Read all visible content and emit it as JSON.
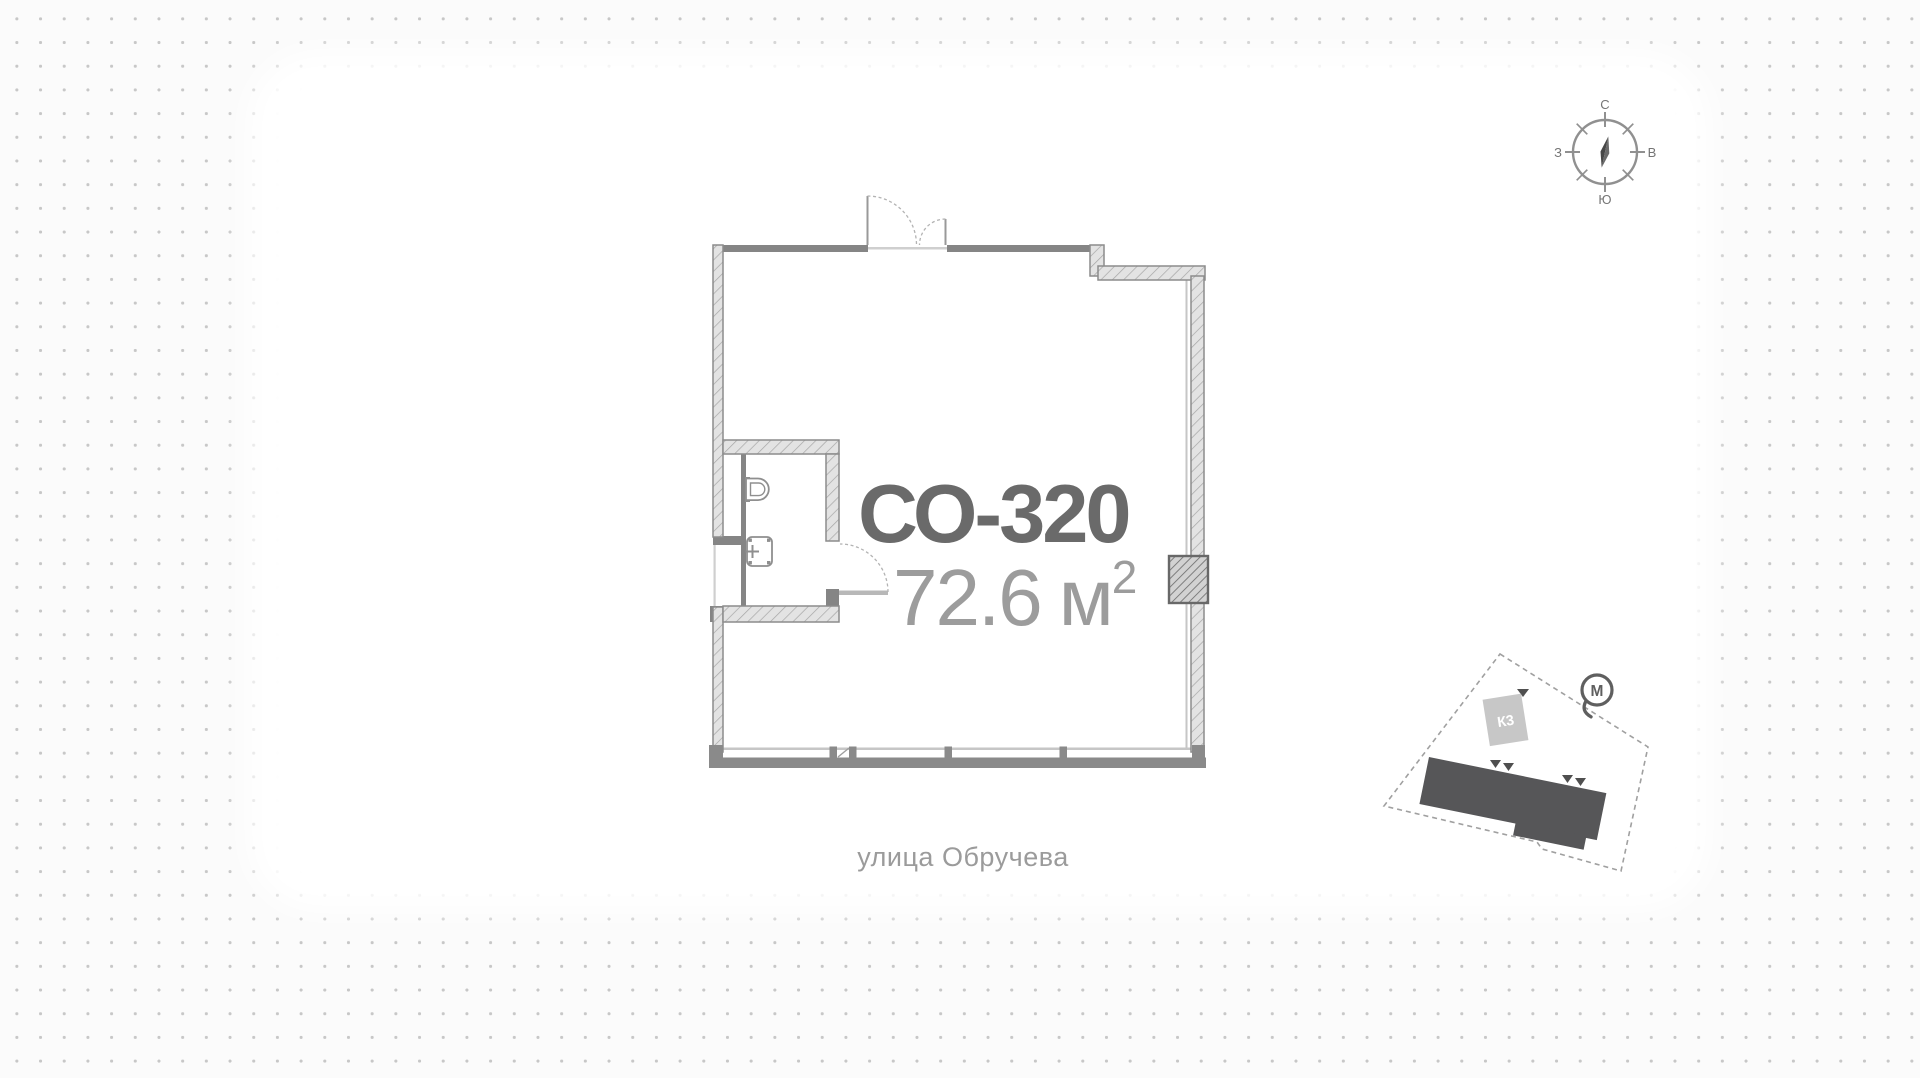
{
  "unit": {
    "title": "СО-320",
    "area_value": "72.6",
    "area_unit": "м",
    "area_exp": "2"
  },
  "street": {
    "label": "улица Обручева"
  },
  "compass": {
    "north": "С",
    "south": "Ю",
    "west": "З",
    "east": "В"
  },
  "site_map": {
    "building_label": "К3",
    "metro_label": "М"
  },
  "colors": {
    "wall": "#858585",
    "wall_hatch_bg": "#e3e3e3",
    "window_line": "#cbcbcb",
    "title_text": "#6a6a6a",
    "muted_text": "#9b9b9b",
    "dot_grid": "#c7c7c7",
    "site_building": "#565658",
    "k3_box": "#c7c7c7"
  }
}
